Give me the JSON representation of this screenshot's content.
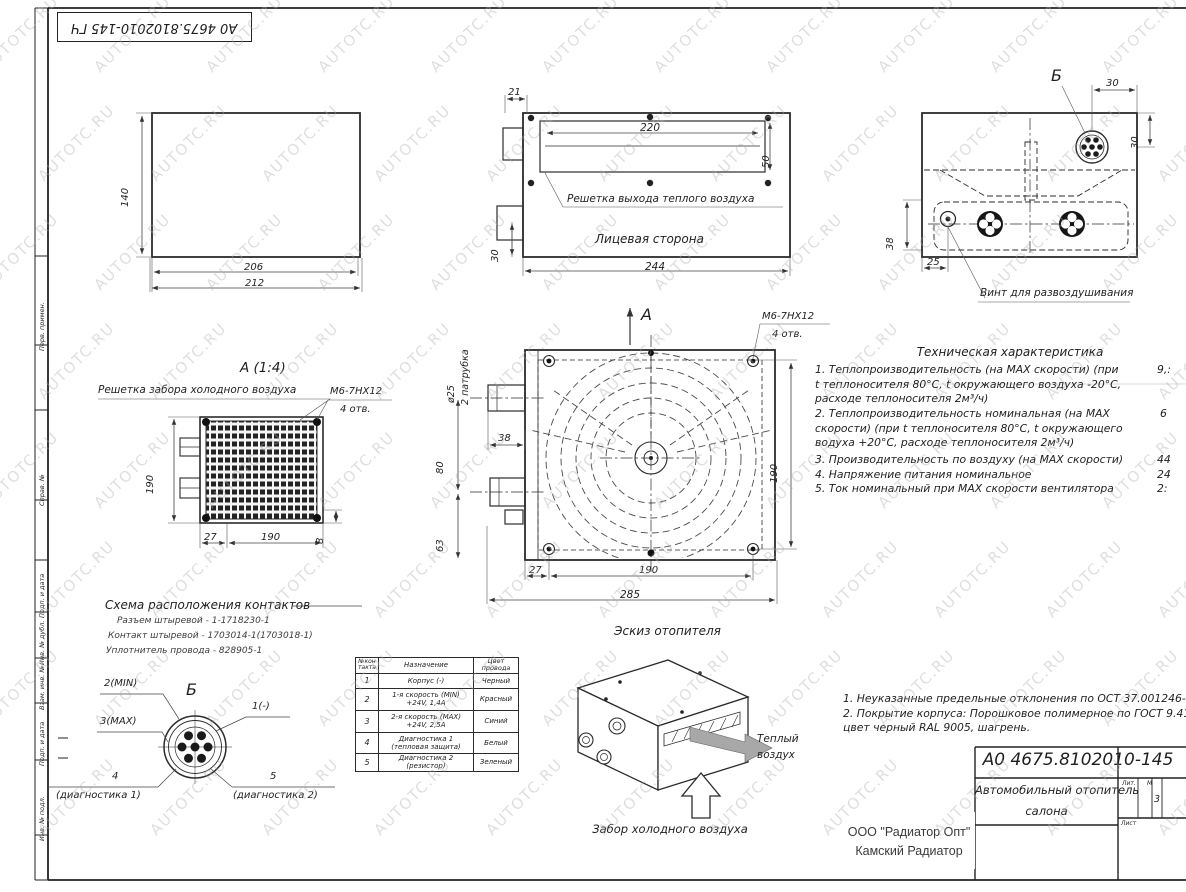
{
  "watermark": "AUTOTC.RU",
  "sheet": {
    "stamp": "А0 4675.8102010-145 ГЧ",
    "frame_labels": [
      "Перв. примен.",
      "Справ. №",
      "Подп. и дата",
      "Инв. № дубл.",
      "Взам. инв. №",
      "Подп. и дата",
      "Инв. № подл."
    ]
  },
  "side_view": {
    "dim_height": "140",
    "dim_width_inner": "206",
    "dim_width_outer": "212"
  },
  "front_view": {
    "dim_offset": "21",
    "dim_slot_width": "220",
    "dim_slot_height": "50",
    "dim_width": "244",
    "dim_pipe": "30",
    "grille_label": "Решетка выхода теплого воздуха",
    "face_label": "Лицевая сторона"
  },
  "top_view": {
    "detail_label": "Б",
    "dim_conn_x": "30",
    "dim_conn_y": "30",
    "dim_38": "38",
    "dim_25": "25",
    "vint_label": "Винт для развоздушивания"
  },
  "grille_view": {
    "title": "А (1:4)",
    "label": "Решетка забора холодного воздуха",
    "bolt": "М6-7НХ12",
    "holes": "4 отв.",
    "dim_height": "190",
    "dim_27": "27",
    "dim_width": "190",
    "dim_8": "8"
  },
  "main_view": {
    "section": "А",
    "bolt": "М6-7НХ12",
    "holes": "4 отв.",
    "pipe_dia": "ø25",
    "pipe_qty": "2 патрубка",
    "dim_38": "38",
    "dim_80": "80",
    "dim_63": "63",
    "dim_height": "190",
    "dim_27": "27",
    "dim_width": "190",
    "dim_total": "285",
    "caption": "Эскиз отопителя"
  },
  "iso_view": {
    "warm1": "Теплый",
    "warm2": "воздух",
    "cold": "Забор холодного воздуха"
  },
  "tech_spec": {
    "title": "Техническая характеристика",
    "lines": [
      {
        "text": "1. Теплопроизводительность (на MAX скорости) (при",
        "value": "9,:"
      },
      {
        "text": "t теплоносителя 80°С, t окружающего воздуха -20°С,",
        "value": ""
      },
      {
        "text": "расходе теплоносителя 2м³/ч)",
        "value": ""
      },
      {
        "text": "2. Теплопроизводительность номинальная (на MAX",
        "value": "6"
      },
      {
        "text": "скорости) (при t теплоносителя 80°С, t окружающего",
        "value": ""
      },
      {
        "text": "водуха +20°С, расходе теплоносителя 2м³/ч)",
        "value": ""
      },
      {
        "text": "3. Производительность по воздуху (на MAX скорости)",
        "value": "44"
      },
      {
        "text": "4. Напряжение питания номинальное",
        "value": "24"
      },
      {
        "text": "5. Ток номинальный при MAX скорости вентилятора",
        "value": "2:"
      }
    ]
  },
  "contacts": {
    "title": "Схема расположения контактов",
    "specs": [
      "Разъем штыревой - 1-1718230-1",
      "Контакт штыревой - 1703014-1(1703018-1)",
      "Уплотнитель провода - 828905-1"
    ],
    "detail": "Б",
    "pin2": "2(MIN)",
    "pin3": "3(MAX)",
    "pin1": "1(-)",
    "pin4": "4",
    "pin4_note": "(диагностика 1)",
    "pin5": "5",
    "pin5_note": "(диагностика 2)"
  },
  "pin_table": {
    "headers": [
      "№кон такта",
      "Назначение",
      "Цвет провода"
    ],
    "rows": [
      {
        "n": "1",
        "fn": "Корпус (-)",
        "fn2": "",
        "color": "Черный"
      },
      {
        "n": "2",
        "fn": "1-я скорость (MIN)",
        "fn2": "+24V, 1,4А",
        "color": "Красный"
      },
      {
        "n": "3",
        "fn": "2-я скорость (MAX)",
        "fn2": "+24V, 2,5А",
        "color": "Синий"
      },
      {
        "n": "4",
        "fn": "Диагностика 1",
        "fn2": "(тепловая защита)",
        "color": "Белый"
      },
      {
        "n": "5",
        "fn": "Диагностика 2",
        "fn2": "(резистор)",
        "color": "Зеленый"
      }
    ]
  },
  "notes": [
    "1. Неуказанные предельные отклонения по ОСТ 37.001246-82.",
    "2. Покрытие корпуса: Порошковое полимерное по ГОСТ 9.410-",
    "цвет черный RAL 9005, шагрень."
  ],
  "title_block": {
    "designation": "А0 4675.8102010-145",
    "name_line1": "Автомобильный отопитель",
    "name_line2": "салона",
    "lit": "Лит.",
    "mass": "М",
    "sheet": "Лист",
    "sheets_value": "3"
  },
  "supplier": {
    "line1": "ООО \"Радиатор Опт\"",
    "line2": "Камский Радиатор"
  }
}
